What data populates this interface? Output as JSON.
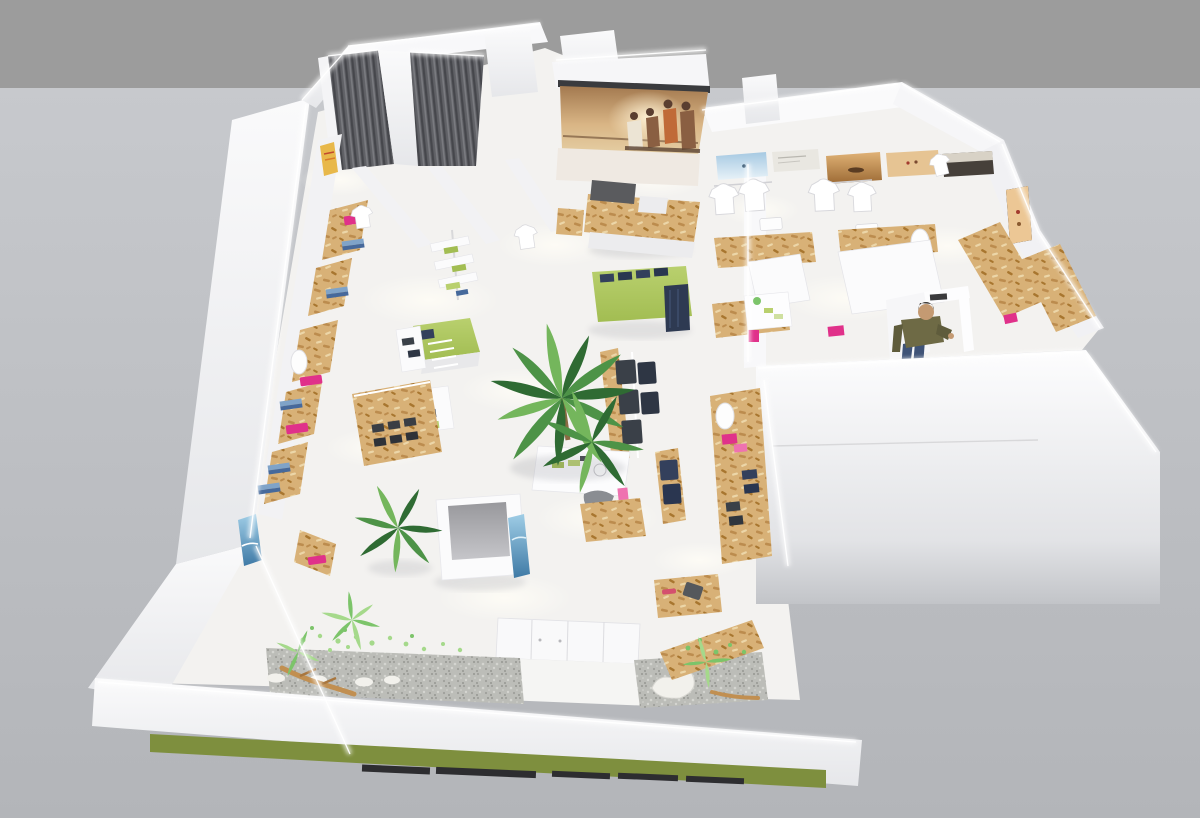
{
  "scene": {
    "kind": "3d-axonometric-cutaway-render",
    "subject": "surf and casual clothing retail store interior floor plan",
    "camera": "elevated three-quarter overhead view",
    "objects": [
      "two-tone gray backdrop",
      "L-shaped white store shell with glowing LED wall edges",
      "two fitting rooms with dark corrugated curtains",
      "large media screen showing a warm sunset beach photo with four seated people",
      "OSB plywood cash counter with dark gray top",
      "row of beach photography posters along rear wall",
      "hanging white t-shirts on wall rails",
      "OSB plywood shelving and display fixtures",
      "left wall shelves with pink and blue folded apparel",
      "blue surf poster on lower left wall",
      "lime-green display tables with folded navy denim",
      "white display tower with green folded shirts",
      "racks of hanging dark denim jeans",
      "large indoor palm trees and small potted plants",
      "white stairwell column with blue poster",
      "entrance vestibule with white cabinets",
      "zen gravel beds with white stepping stones, driftwood and leaf scatter",
      "heart-shaped white stone",
      "male shopper figure near fitting door",
      "large white exterior wall slab with LED edge",
      "storefront fascia with olive-green signage band",
      "dark window slats on front apron"
    ]
  },
  "palette": {
    "bg_top": "#9c9c9c",
    "bg_main_top": "#c7c9cd",
    "bg_main_bottom": "#b3b5b9",
    "wall_white": "#fafafb",
    "wall_shade": "#e6e7ea",
    "floor": "#f3f2f0",
    "floor_glow": "#fffdf6",
    "led": "#ffffff",
    "osb_base": "#d8b177",
    "osb_dot_dark": "#bc8c4e",
    "osb_dot_deep": "#a8762f",
    "osb_dot_light": "#ecd6a8",
    "curtain_base": "#606166",
    "curtain_dark": "#46474c",
    "curtain_light": "#7a7b80",
    "opening_top": "#98989c",
    "opening_bottom": "#c6c6ca",
    "lime": "#b9d06e",
    "lime_deep": "#a2bd52",
    "olive_band": "#7e8f3e",
    "magenta": "#e0318a",
    "pink_light": "#ef72b0",
    "blue_cloth": "#7fa3c8",
    "blue_cloth_deep": "#46699b",
    "navy": "#33405c",
    "garment_dark": "#3a4048",
    "gravel": "#bcbdb8",
    "gravel_dot_dark": "#9fa09b",
    "gravel_dot_light": "#d4d5d0",
    "stone_white": "#f2f1ec",
    "driftwood": "#c18f51",
    "leaf_light": "#a5d98b",
    "leaf_mid": "#7cc46a",
    "palm_dark": "#2f6b33",
    "palm_mid": "#4d9347",
    "palm_light": "#74b65c",
    "screen_sky_top": "#a3794f",
    "screen_sky_mid": "#d9b585",
    "screen_sand": "#e6d0a6",
    "screen_glare": "#fff3d6",
    "silhouette_dark": "#5a3e30",
    "silhouette_brown": "#8a5f42",
    "shirt_cream": "#ece4d4",
    "vest_orange": "#c06a38",
    "poster_sky_blue": "#a6c9e2",
    "poster_sea_top": "#9fcde6",
    "poster_sea_deep": "#3f7aa6",
    "poster_warm": "#e0b276",
    "poster_warm_deep": "#9c6a34",
    "poster_dark": "#46403a",
    "poster_pale": "#e9e7e1",
    "counter_gray": "#5a5b5e",
    "slat_dark": "#2d2d30",
    "person_shirt": "#6e6a45",
    "person_jeans": "#3f5377",
    "person_skin": "#c49a72",
    "person_hair": "#3c3833",
    "shadow": "#7c7e88"
  }
}
